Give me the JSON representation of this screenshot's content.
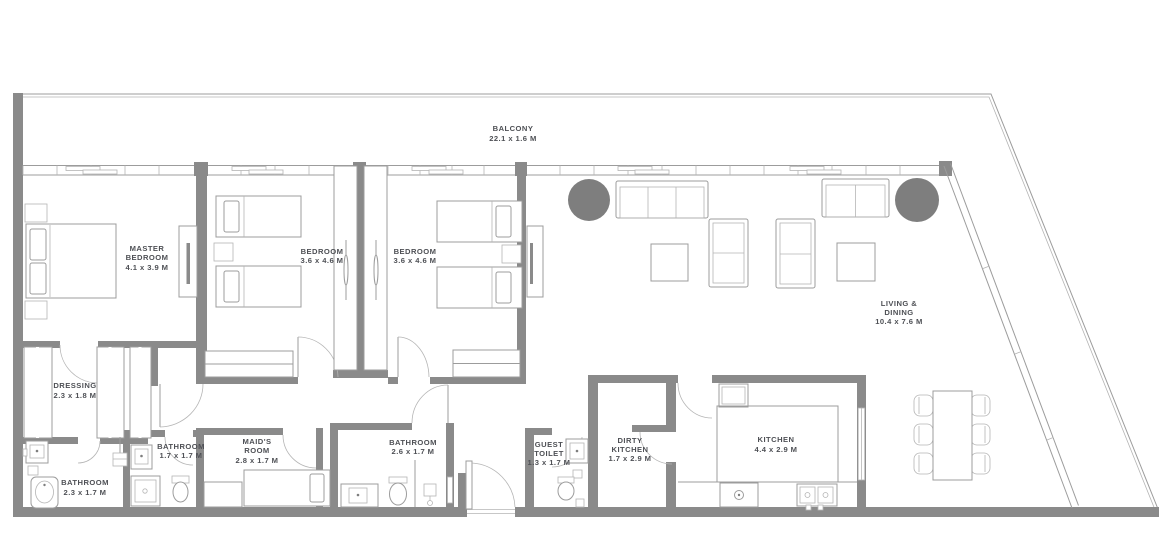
{
  "document_type": "apartment floor plan",
  "colors": {
    "wall": "#8a8a8a",
    "line": "#9c9c9c",
    "line2": "#b5b5b5",
    "accent": "#7e7e7e",
    "text": "#4e5055",
    "bg": "#ffffff"
  },
  "rooms": {
    "balcony": {
      "line1": "BALCONY",
      "dims": "22.1 x 1.6 M"
    },
    "master": {
      "line1": "MASTER",
      "line2": "BEDROOM",
      "dims": "4.1 x 3.9 M"
    },
    "bedroom2": {
      "line1": "BEDROOM",
      "dims": "3.6 x 4.6 M"
    },
    "bedroom3": {
      "line1": "BEDROOM",
      "dims": "3.6 x 4.6 M"
    },
    "living": {
      "line1": "LIVING &",
      "line2": "DINING",
      "dims": "10.4 x 7.6 M"
    },
    "dressing": {
      "line1": "DRESSING",
      "dims": "2.3 x 1.8 M"
    },
    "bath_master": {
      "line1": "BATHROOM",
      "dims": "2.3 x 1.7 M"
    },
    "bath_small": {
      "line1": "BATHROOM",
      "dims": "1.7 x 1.7 M"
    },
    "maids": {
      "line1": "MAID'S",
      "line2": "ROOM",
      "dims": "2.8 x 1.7 M"
    },
    "bath_mid": {
      "line1": "BATHROOM",
      "dims": "2.6 x 1.7 M"
    },
    "guest_toilet": {
      "line1": "GUEST",
      "line2": "TOILET",
      "dims": "1.3 x 1.7 M"
    },
    "dirty_kitchen": {
      "line1": "DIRTY",
      "line2": "KITCHEN",
      "dims": "1.7 x 2.9 M"
    },
    "kitchen": {
      "line1": "KITCHEN",
      "dims": "4.4 x 2.9 M"
    }
  }
}
